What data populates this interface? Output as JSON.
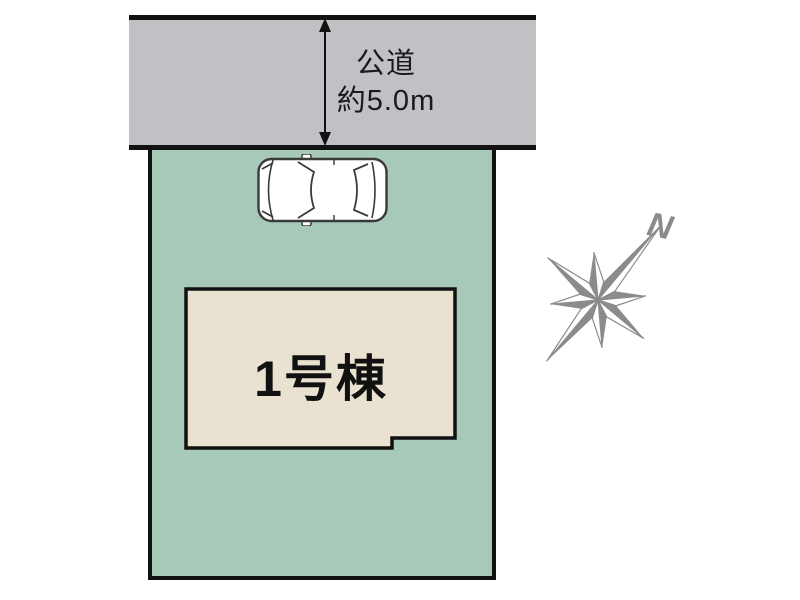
{
  "road": {
    "label_line1": "公道",
    "label_line2": "約5.0m",
    "fill_color": "#c1c0c4",
    "border_color": "#121212"
  },
  "plot": {
    "fill_color": "#a7c9b7",
    "border_color": "#121212"
  },
  "building": {
    "label": "1号棟",
    "fill_color": "#eae2d0",
    "border_color": "#111111"
  },
  "compass": {
    "north_label": "N",
    "color": "#8b8b8d"
  },
  "car": {
    "body_color": "#ffffff",
    "outline_color": "#3a3a3a"
  },
  "icons": {
    "arrow": "road-width-double-arrow-icon",
    "car": "car-top-view-icon",
    "compass": "compass-rose-icon"
  }
}
